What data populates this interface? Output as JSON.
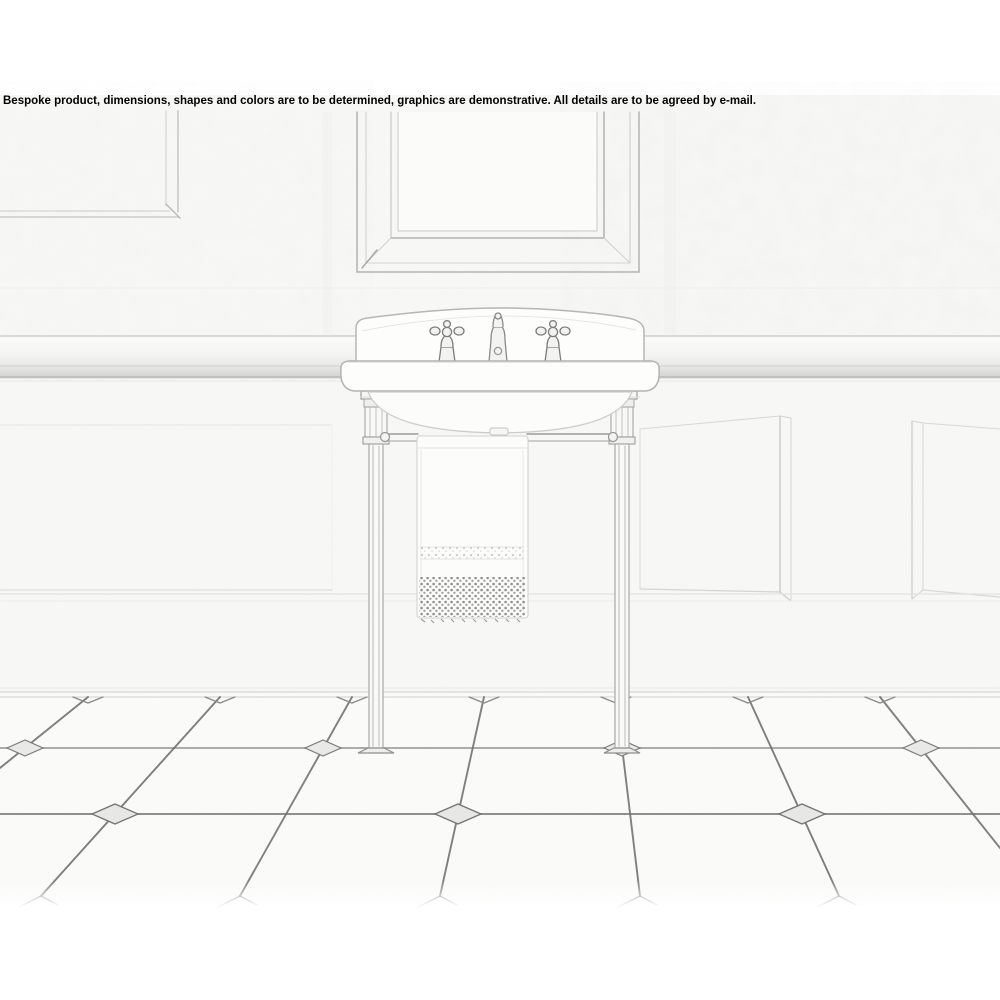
{
  "banner": {
    "disclaimer": "Bespoke product, dimensions, shapes and colors are to be determined, graphics are demonstrative. All details are to be agreed by e-mail."
  },
  "illustration": {
    "style": "light pencil-sketch rendering",
    "subject": "console washbasin with chrome legs and towel rail in a panelled bathroom",
    "elements": [
      "framed mirror",
      "upper wall panel",
      "dado rail",
      "wainscot panels",
      "washbasin with backsplash and three taps",
      "two chrome console legs",
      "towel rail with hanging fringed towel",
      "diagonal tiled floor with diamond insets"
    ]
  },
  "colors": {
    "background": "#ffffff",
    "banner_text": "#000000",
    "wall_tint": "#f9f9f8",
    "floor_tint": "#fcfcfb",
    "sketch_light": "#d6d6d4",
    "sketch_mid": "#b0b0ae",
    "sketch_dark": "#6e6e6c"
  }
}
